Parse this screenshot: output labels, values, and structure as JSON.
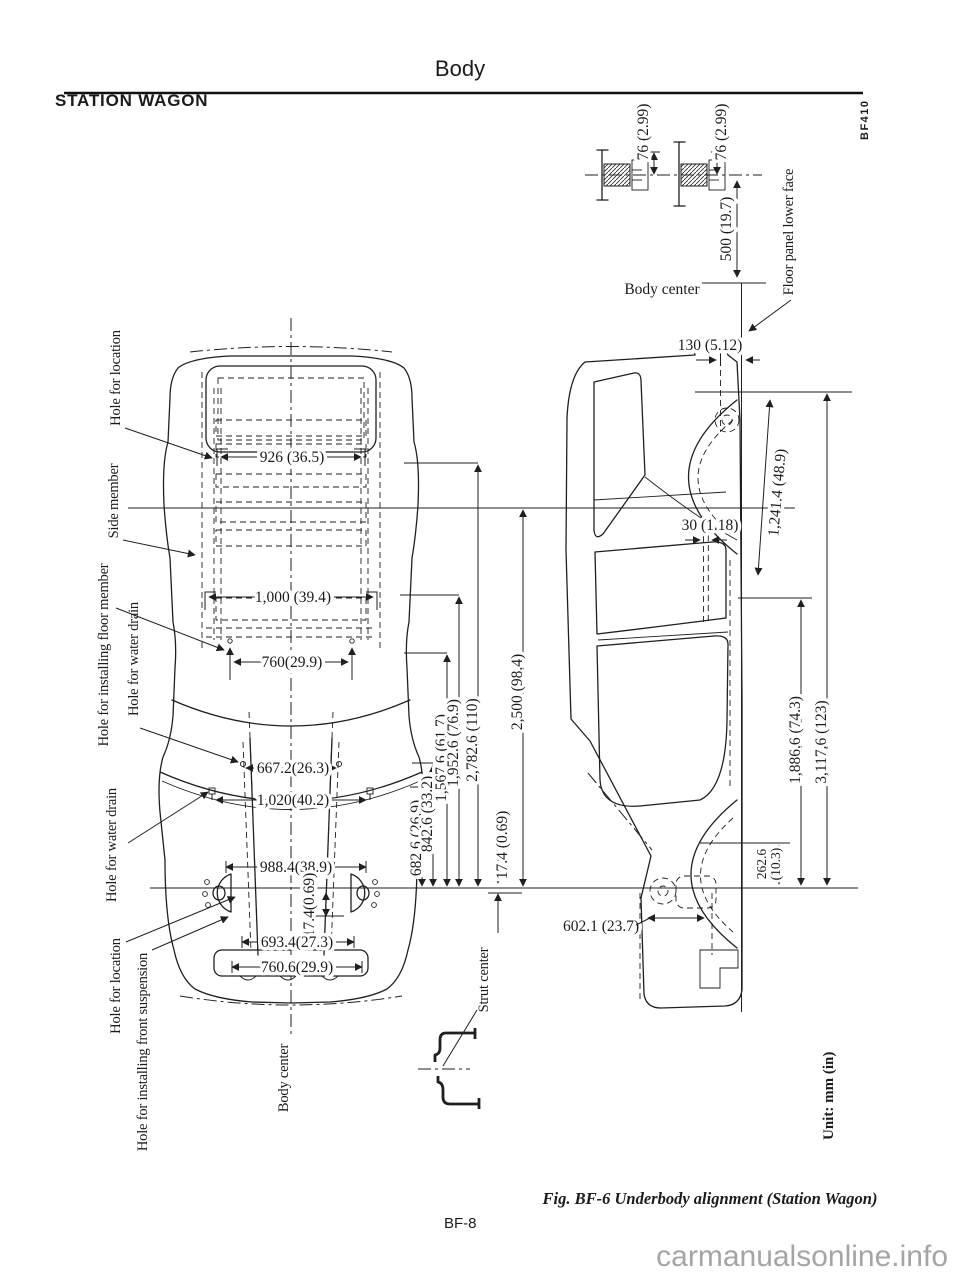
{
  "page": {
    "header_title": "Body",
    "section_title": "STATION WAGON",
    "code": "BF410",
    "caption": "Fig. BF-6  Underbody alignment (Station Wagon)",
    "page_number": "BF-8",
    "watermark": "carmanualsonline.info",
    "unit_note": "Unit:  mm (in)"
  },
  "detail_diagram": {
    "dim_76_left": "76 (2.99)",
    "dim_76_right": "76 (2.99)",
    "dim_500": "500 (19.7)",
    "body_center_label": "Body center",
    "floor_panel_label": "Floor panel lower face"
  },
  "top_view": {
    "body_center_label": "Body center",
    "labels": {
      "hole_location_rear": "Hole for location",
      "side_member": "Side member",
      "floor_member": "Hole for installing floor member",
      "water_drain_rear": "Hole for water drain",
      "water_drain_front": "Hole for water drain",
      "hole_location_front": "Hole for location",
      "front_suspension": "Hole for installing front suspension"
    },
    "dims": {
      "w926": "926 (36.5)",
      "w1000": "1,000 (39.4)",
      "w760": "760(29.9)",
      "w667": "667.2(26.3)",
      "w1020": "1,020(40.2)",
      "w988": "988.4(38.9)",
      "w174": "17.4(0.69)",
      "w693": "693.4(27.3)",
      "w7606": "760.6(29.9)",
      "l682": "682.6 (26.9)",
      "l842": "842.6 (33.2)",
      "l1567": "1,567.6 (61.7)",
      "l1952": "1,952.6 (76.9)",
      "l2782": "2,782.6 (110)",
      "l174": "17.4 (0.69)",
      "l2500": "2,500 (98.4)"
    }
  },
  "side_view": {
    "strut_center_label": "Strut center",
    "dims": {
      "d130": "130 (5.12)",
      "d30": "30 (1.18)",
      "d1241": "1,241.4 (48.9)",
      "d1886": "1,886.6 (74.3)",
      "d3117": "3,117.6 (123)",
      "d262_line1": "262.6",
      "d262_line2": "(10.3)",
      "d602": "602.1 (23.7)",
      "strut_center": "Strut center"
    }
  }
}
